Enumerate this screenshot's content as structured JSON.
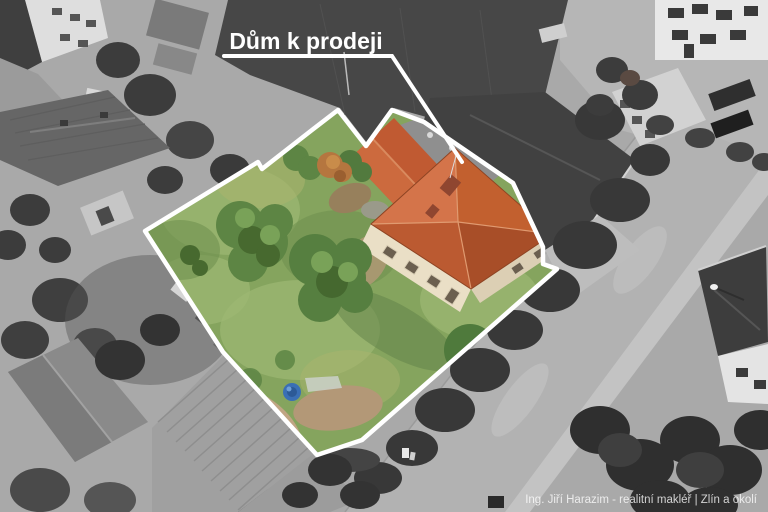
{
  "overlay": {
    "label": "Dům k prodeji",
    "watermark": "Ing. Jiří Harazim - realitní makléř | Zlín a okolí"
  },
  "colors": {
    "boundary_white": "#ffffff",
    "roof_orange": "#c2602f",
    "roof_orange_light": "#d4744a",
    "roof_orange_dark": "#a84e28",
    "roof_orange_sw": "#bb5a31",
    "wing_orange": "#c05a32",
    "wall_cream": "#eadfc6",
    "wall_cream_shade": "#dccfb4",
    "window_dark": "#6b5f4f",
    "lawn_green": "#85a45e",
    "lawn_light": "#9cb873",
    "lawn_dark": "#6f9150",
    "lawn_yellow": "#a9b46e",
    "bush_green": "#5d8544",
    "bush_dark": "#47692f",
    "bush_light": "#79a258",
    "tree_green_dark": "#4f7a3c",
    "autumn_orange": "#b5763f",
    "dirt_brown": "#b39877",
    "dirt_light": "#c0a584",
    "barrel_blue": "#3a6fb5",
    "road_gray": "#b2b2b2",
    "sidewalk_gray": "#c3c3c3",
    "dark_roof_gray": "#474747",
    "tree_gray": "#3c3c3c",
    "ground_gray": "#a9a9a9"
  },
  "scene": {
    "subject": "aerial-view-house-for-sale",
    "highlighted_area": "property-plot-with-garden-and-house",
    "surroundings": "grayscale-neighborhood"
  }
}
